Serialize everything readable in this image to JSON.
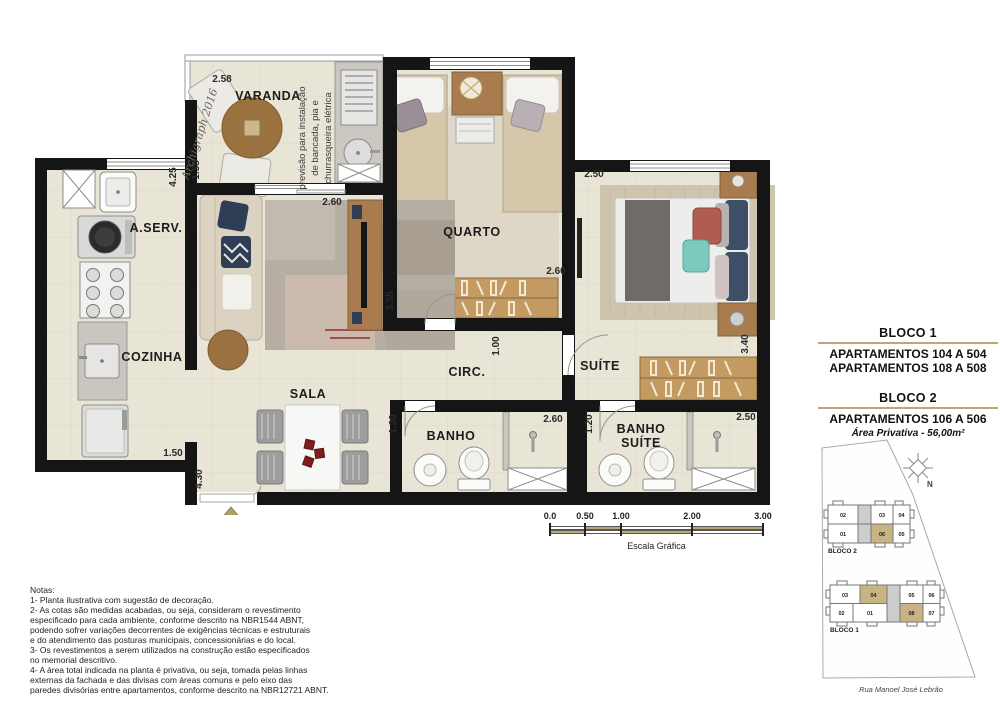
{
  "plan": {
    "rooms": {
      "varanda": "VARANDA",
      "quarto": "QUARTO",
      "aserv": "A.SERV.",
      "cozinha": "COZINHA",
      "sala": "SALA",
      "circ": "CIRC.",
      "suite": "SUÍTE",
      "banho": "BANHO",
      "banho_suite_line1": "BANHO",
      "banho_suite_line2": "SUÍTE"
    },
    "dims": {
      "varanda_width": "2.58",
      "varanda_depth": "1.58",
      "aserv_length": "4.25",
      "sala_width": "2.60",
      "quarto_width": "2.60",
      "quarto_depth": "3.55",
      "circ_width": "1.00",
      "suite_width": "2.50",
      "suite_depth": "3.40",
      "banho_width": "2.60",
      "banho_depth": "1.20",
      "banho_suite_width": "2.50",
      "banho_suite_depth": "1.20",
      "cozinha_width": "1.50",
      "sala_length": "4.30"
    },
    "varanda_note": {
      "line1": "previsão para instalação",
      "line2": "de bancada, pia e",
      "line3": "churrasqueira elétrica"
    },
    "signature": "Archigraph 2016"
  },
  "info": {
    "bloco1_title": "BLOCO 1",
    "bloco1_line1": "APARTAMENTOS 104 A 504",
    "bloco1_line2": "APARTAMENTOS 108 A 508",
    "bloco2_title": "BLOCO 2",
    "bloco2_line1": "APARTAMENTOS 106 A 506",
    "area": "Área Privativa - 56,00m²"
  },
  "scale": {
    "labels": [
      "0.0",
      "0.50",
      "1.00",
      "2.00",
      "3.00"
    ],
    "caption": "Escala Gráfica"
  },
  "site": {
    "north_label": "N",
    "street": "Rua Manoel José Lebrão",
    "bloco2": {
      "label": "BLOCO 2",
      "top_units": [
        "02",
        "03",
        "04"
      ],
      "bottom_units": [
        "01",
        "06",
        "05"
      ],
      "highlighted": [
        "06"
      ]
    },
    "bloco1": {
      "label": "BLOCO 1",
      "top_units": [
        "03",
        "04",
        "05",
        "06"
      ],
      "bottom_units": [
        "02",
        "01",
        "08",
        "07"
      ],
      "highlighted": [
        "04",
        "08"
      ]
    }
  },
  "notes": {
    "title": "Notas:",
    "lines": [
      "1- Planta ilustrativa com sugestão de decoração.",
      "2- As cotas são medidas acabadas, ou seja, consideram o revestimento",
      "especificado para cada ambiente, conforme descrito na NBR1544 ABNT,",
      "podendo sofrer variações decorrentes de exigências técnicas e estruturais",
      "e do atendimento das posturas municipais, concessionárias e do local.",
      "3- Os revestimentos a serem utilizados na construção estão especificados",
      "no memorial descritivo.",
      "4- A área total indicada na planta é privativa, ou seja, tomada pelas linhas",
      "externas da fachada e das divisas com áreas comuns e pelo eixo das",
      "paredes divisórias entre apartamentos, conforme descrito na NBR12721 ABNT."
    ]
  },
  "colors": {
    "wall": "#151515",
    "floor": "#e8e4d6",
    "accent_tan": "#b9a878",
    "unit_highlight": "#c8b385",
    "entry_arrow": "#b3a266"
  }
}
